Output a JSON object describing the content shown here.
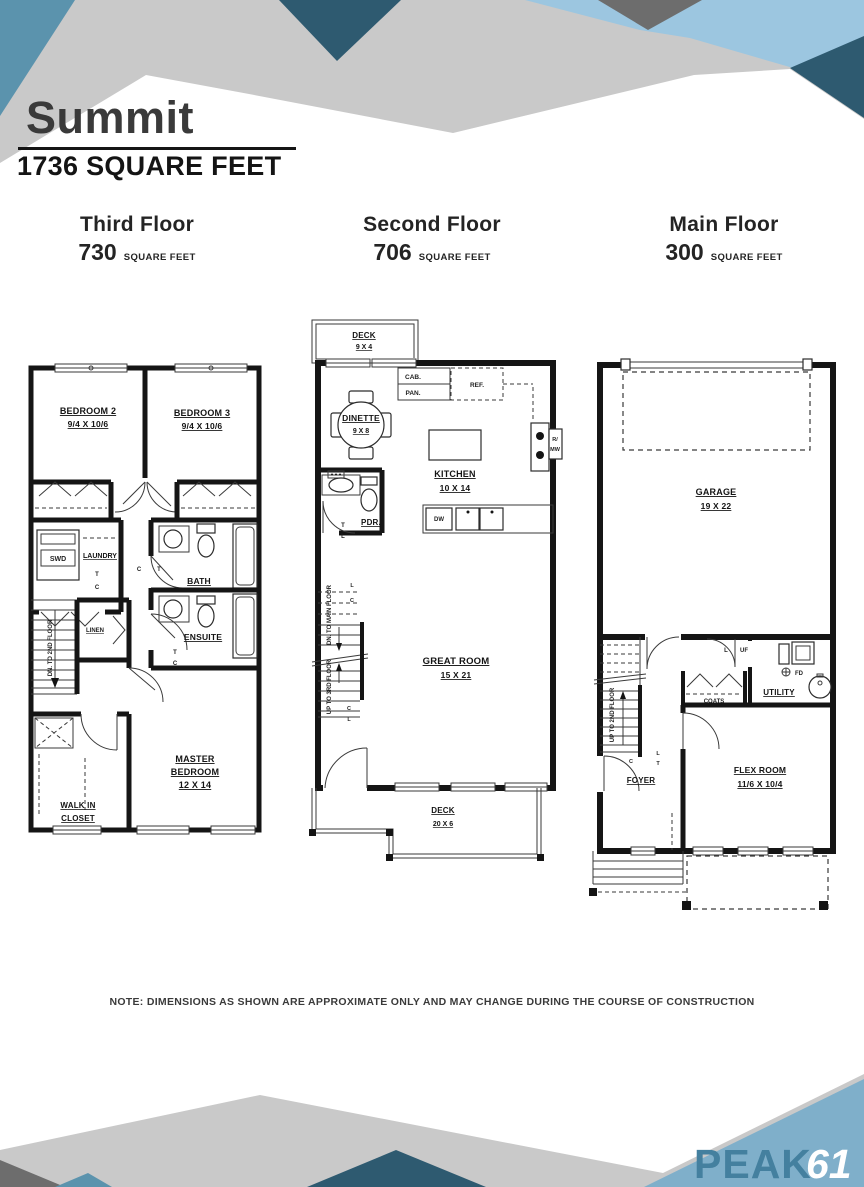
{
  "title": "Summit",
  "subtitle": "1736 SQUARE FEET",
  "floors": [
    {
      "name": "Third Floor",
      "sqft": "730",
      "unit": "SQUARE FEET"
    },
    {
      "name": "Second Floor",
      "sqft": "706",
      "unit": "SQUARE FEET"
    },
    {
      "name": "Main Floor",
      "sqft": "300",
      "unit": "SQUARE FEET"
    }
  ],
  "plans": {
    "third": {
      "bedroom2": "BEDROOM 2",
      "bedroom2_dim": "9/4 X 10/6",
      "bedroom3": "BEDROOM 3",
      "bedroom3_dim": "9/4 X 10/6",
      "swd": "SWD",
      "laundry": "LAUNDRY",
      "bath": "BATH",
      "ensuite": "ENSUITE",
      "linen": "LINEN",
      "stairs": "DN. TO 2ND FLOOR",
      "walkin_1": "WALK IN",
      "walkin_2": "CLOSET",
      "master_1": "MASTER",
      "master_2": "BEDROOM",
      "master_dim": "12 X 14"
    },
    "second": {
      "deck_top": "DECK",
      "deck_top_dim": "9 X 4",
      "dinette": "DINETTE",
      "dinette_dim": "9 X 8",
      "cab": "CAB.",
      "pan": "PAN.",
      "ref": "REF.",
      "r_mw_1": "R/",
      "r_mw_2": "MW",
      "kitchen": "KITCHEN",
      "kitchen_dim": "10 X 14",
      "dw": "DW",
      "pdr": "PDR.",
      "stairs_dn": "DN. TO MAIN FLOOR",
      "stairs_up": "UP TO 3RD FLOOR",
      "great_room": "GREAT ROOM",
      "great_room_dim": "15 X 21",
      "deck_bottom": "DECK",
      "deck_bottom_dim": "20 X 6"
    },
    "main": {
      "garage": "GARAGE",
      "garage_dim": "19 X 22",
      "stairs_up": "UP TO 2ND FLOOR",
      "foyer": "FOYER",
      "coats": "COATS",
      "utility": "UTILITY",
      "uf": "UF",
      "fd": "FD",
      "flex": "FLEX ROOM",
      "flex_dim": "11/6 X 10/4"
    },
    "marks": {
      "t": "T",
      "c": "C",
      "l": "L"
    }
  },
  "note": "NOTE: DIMENSIONS AS SHOWN ARE APPROXIMATE ONLY AND MAY CHANGE DURING THE COURSE OF CONSTRUCTION",
  "logo": {
    "peak": "PEAK",
    "num": "61"
  },
  "colors": {
    "light_gray": "#c9c9c9",
    "dark_gray": "#6d6d6d",
    "steel_blue": "#5b93ad",
    "teal_dark": "#2e5a70",
    "light_blue": "#9cc6e0",
    "footer_blue": "#7fafca",
    "logo_teal": "#44809f"
  }
}
